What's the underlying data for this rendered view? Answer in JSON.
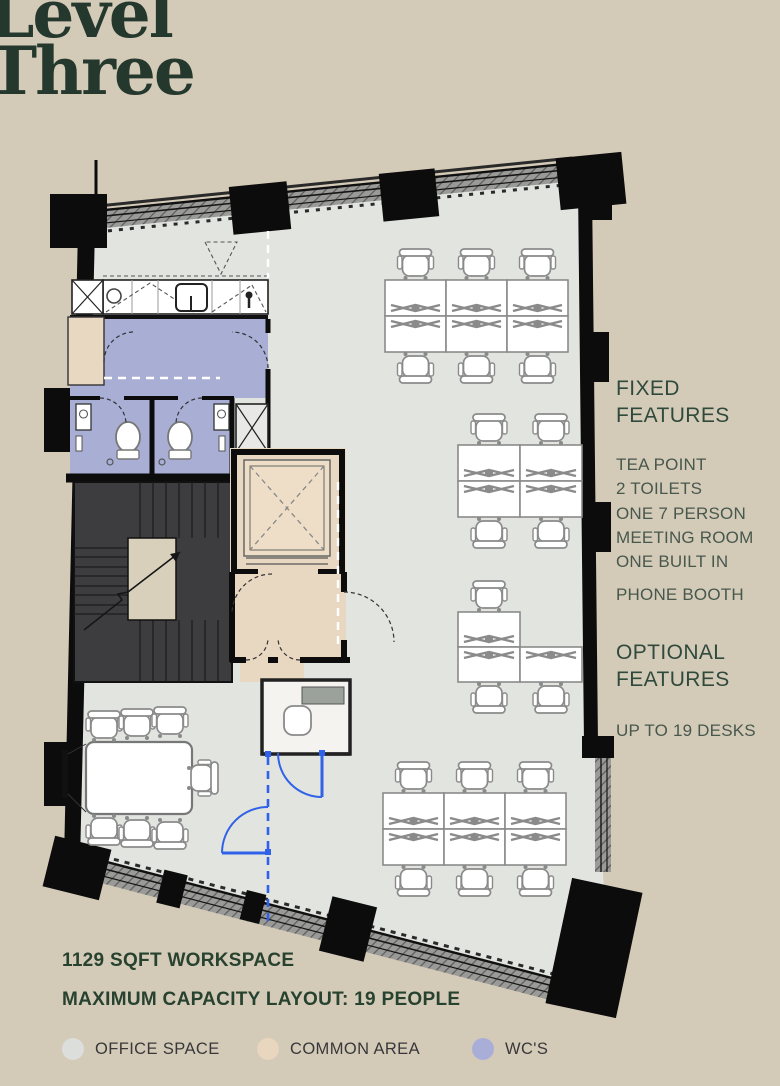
{
  "page": {
    "background": "#d4cab8"
  },
  "title": {
    "line1": "Level",
    "line2": "Three"
  },
  "fixed_features": {
    "heading": "FIXED FEATURES",
    "lines": [
      "TEA POINT",
      "2 TOILETS",
      "ONE 7 PERSON",
      "MEETING ROOM",
      "ONE BUILT IN",
      "PHONE BOOTH"
    ]
  },
  "optional_features": {
    "heading": "OPTIONAL FEATURES",
    "lines": [
      "UP TO 19 DESKS"
    ]
  },
  "stats": {
    "line1": "1129 SQFT WORKSPACE",
    "line2": "MAXIMUM CAPACITY LAYOUT: 19 PEOPLE"
  },
  "legend": {
    "items": [
      {
        "label": "OFFICE SPACE",
        "color": "#dcdedb",
        "x": 62
      },
      {
        "label": "COMMON AREA",
        "color": "#e8d6bf",
        "x": 257
      },
      {
        "label": "WC'S",
        "color": "#a9aed8",
        "x": 472
      }
    ]
  },
  "plan": {
    "desk_total": 19,
    "colors": {
      "office": "#e2e4e0",
      "common": "#e9d8c1",
      "wc": "#a9aed5",
      "wall": "#0c0c0c",
      "stair": "#3d3d3f",
      "glazing": "#9a9a98",
      "furniture_stroke": "#8a8a8a",
      "door_blue": "#2f62e8"
    },
    "desk_banks": [
      {
        "name": "desk-bank-north",
        "x": 385,
        "y": 280,
        "cols": 3,
        "rows": 2,
        "dw": 61,
        "dh": 36,
        "omit": [],
        "chairs_top": [
          0,
          1,
          2
        ],
        "chairs_bottom": [
          0,
          1,
          2
        ]
      },
      {
        "name": "desk-bank-mid-upper",
        "x": 458,
        "y": 445,
        "cols": 2,
        "rows": 2,
        "dw": 62,
        "dh": 36,
        "omit": [],
        "chairs_top": [
          0,
          1
        ],
        "chairs_bottom": [
          0,
          1
        ]
      },
      {
        "name": "desk-bank-mid-lower",
        "x": 458,
        "y": 612,
        "cols": 2,
        "rows": 2,
        "dw": 62,
        "dh": 35,
        "omit": [
          [
            0,
            1
          ]
        ],
        "chairs_top": [
          0
        ],
        "chairs_bottom": [
          0,
          1
        ]
      },
      {
        "name": "desk-bank-south",
        "x": 383,
        "y": 793,
        "cols": 3,
        "rows": 2,
        "dw": 61,
        "dh": 36,
        "omit": [],
        "chairs_top": [
          0,
          1,
          2
        ],
        "chairs_bottom": [
          0,
          1,
          2
        ]
      }
    ],
    "meeting_chairs": {
      "top": [
        [
          104,
          726
        ],
        [
          137,
          724
        ],
        [
          170,
          722
        ]
      ],
      "bottom": [
        [
          104,
          830
        ],
        [
          137,
          832
        ],
        [
          170,
          834
        ]
      ],
      "right": [
        [
          203,
          778
        ]
      ]
    }
  }
}
